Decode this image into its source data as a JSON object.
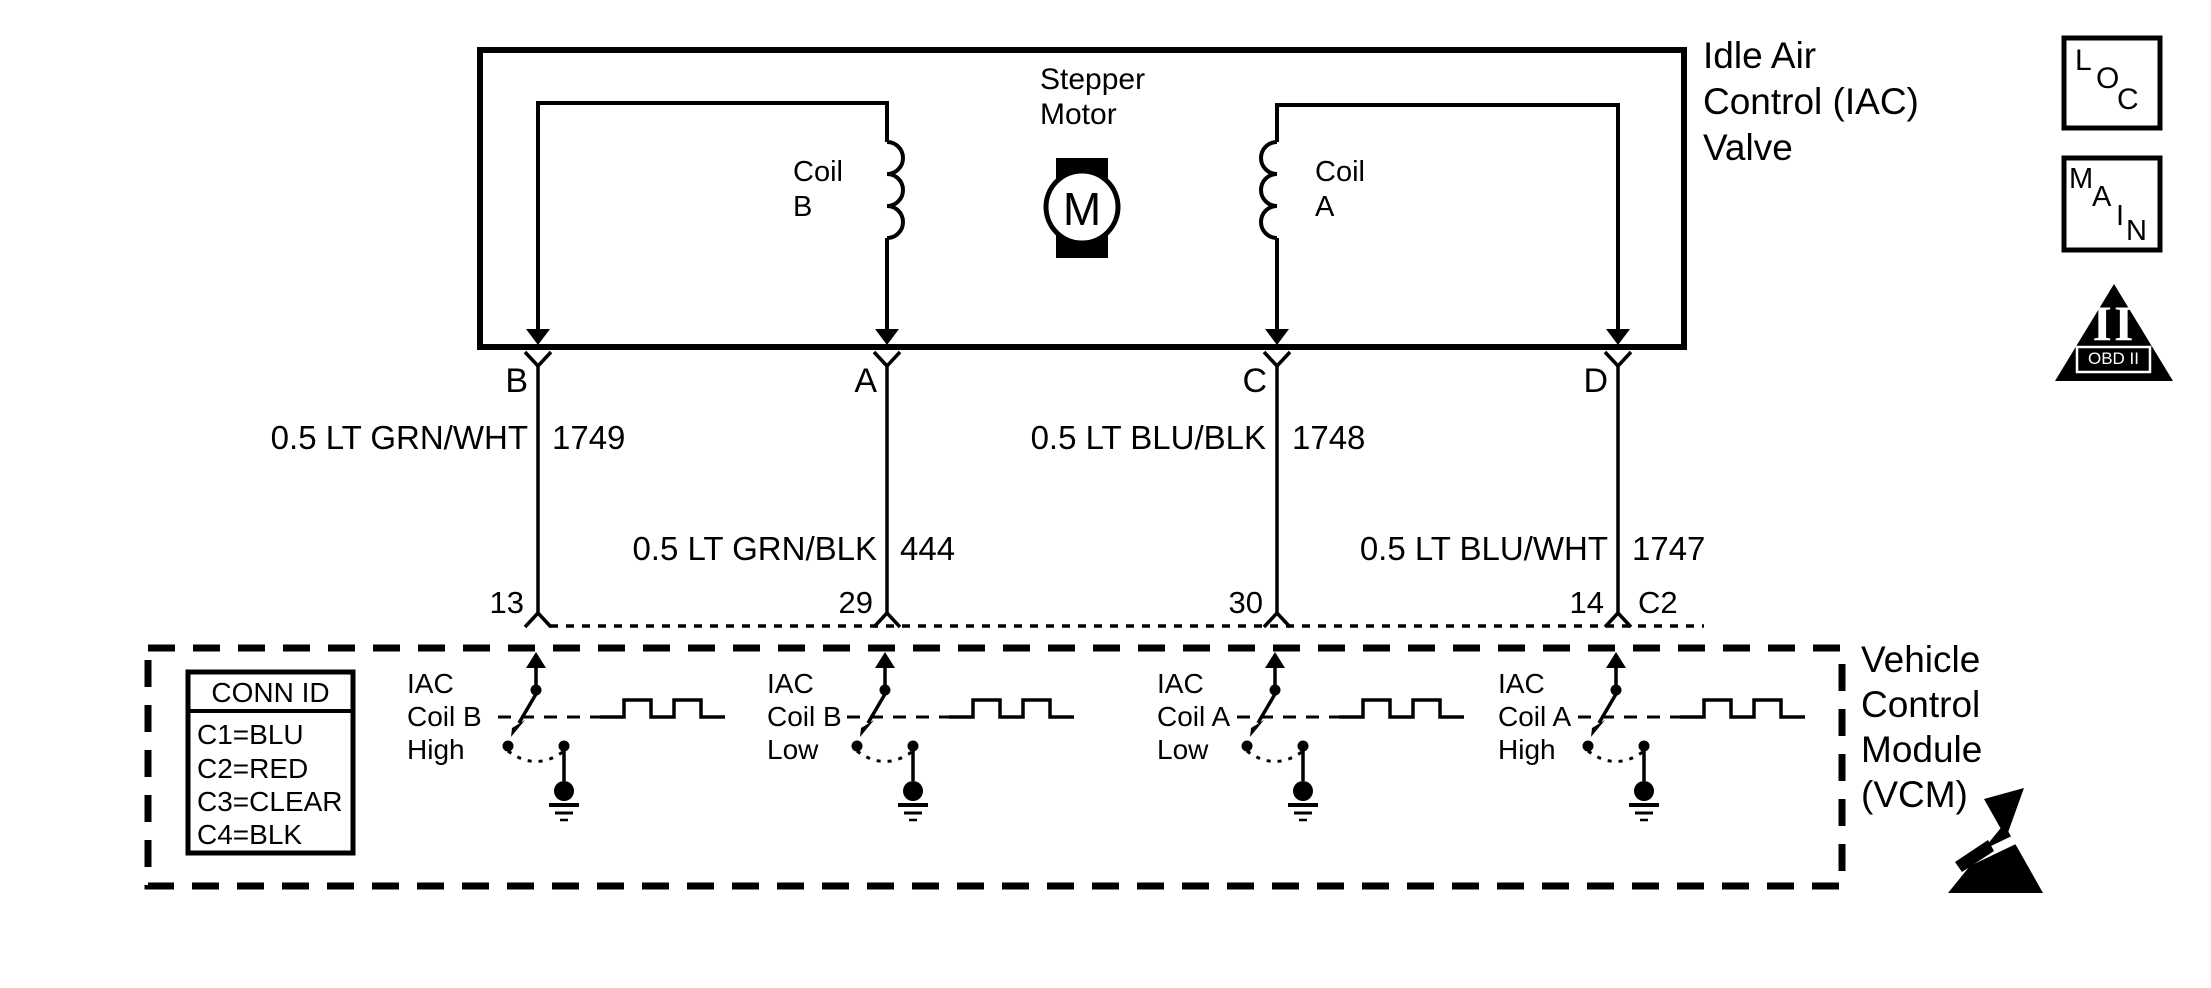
{
  "iac_valve": {
    "title": "Idle Air\nControl (IAC)\nValve",
    "stepper_motor_label": "Stepper\nMotor",
    "motor_letter": "M",
    "coil_b_label": "Coil\nB",
    "coil_a_label": "Coil\nA"
  },
  "wires": [
    {
      "terminal": "B",
      "label": "0.5 LT GRN/WHT",
      "circuit": "1749",
      "pin": "13"
    },
    {
      "terminal": "A",
      "label": "0.5 LT GRN/BLK",
      "circuit": "444",
      "pin": "29"
    },
    {
      "terminal": "C",
      "label": "0.5 LT BLU/BLK",
      "circuit": "1748",
      "pin": "30"
    },
    {
      "terminal": "D",
      "label": "0.5 LT BLU/WHT",
      "circuit": "1747",
      "pin": "14"
    }
  ],
  "vcm": {
    "title": "Vehicle\nControl\nModule\n(VCM)",
    "connector_label": "C2",
    "conn_id": {
      "header": "CONN ID",
      "rows": [
        "C1=BLU",
        "C2=RED",
        "C3=CLEAR",
        "C4=BLK"
      ]
    },
    "drivers": [
      "IAC\nCoil B\nHigh",
      "IAC\nCoil B\nLow",
      "IAC\nCoil A\nLow",
      "IAC\nCoil A\nHigh"
    ]
  },
  "legend": {
    "loc": [
      "L",
      "O",
      "C"
    ],
    "main": [
      "M",
      "A",
      "I",
      "N"
    ],
    "obd": {
      "numeral": "II",
      "label": "OBD II"
    }
  },
  "colors": {
    "line": "#000000",
    "background": "#ffffff"
  }
}
